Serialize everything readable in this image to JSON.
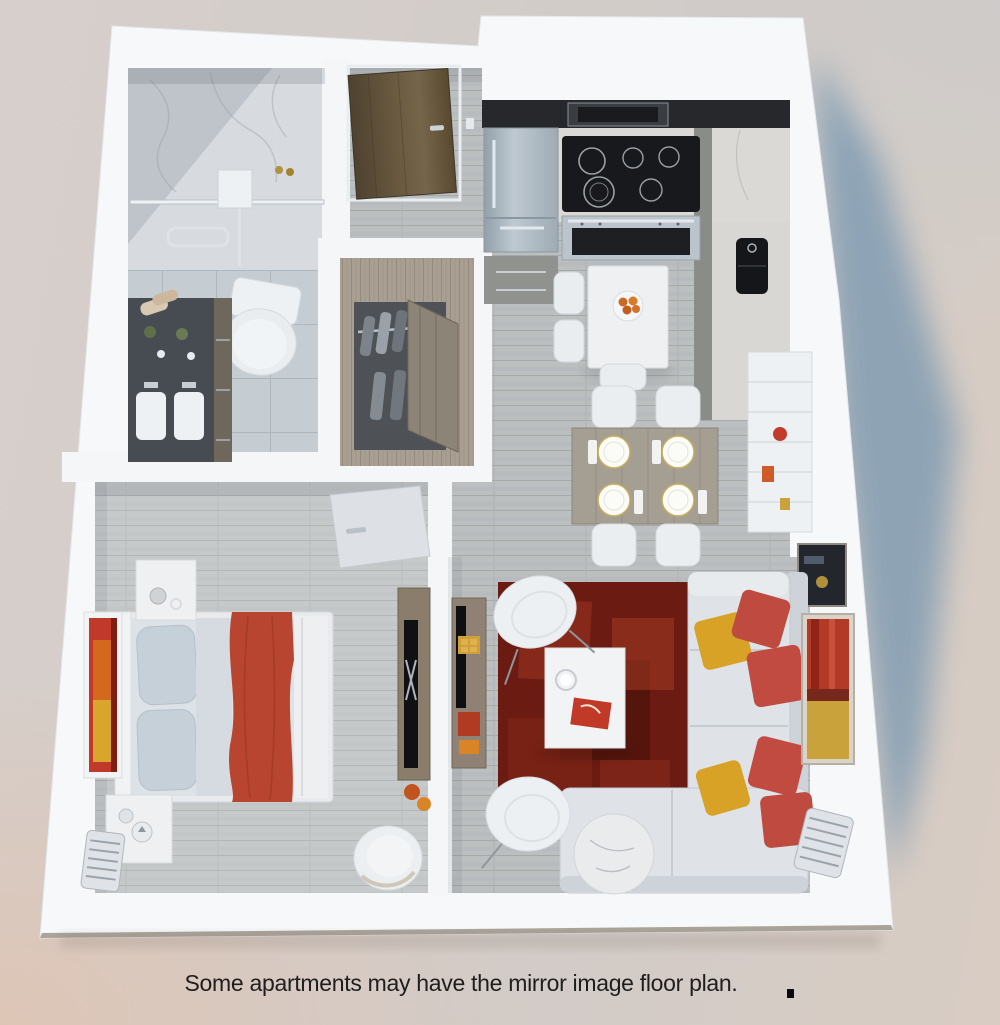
{
  "caption": {
    "text": "Some apartments may have the mirror image floor plan."
  },
  "palette": {
    "wall_white": "#f6f8fa",
    "shadow_blue": "#7d9ab1",
    "rug_red": "#6b1b12",
    "pillow_red": "#c14a41",
    "pillow_yellow": "#d7a226",
    "blanket_red": "#b8452f",
    "sofa_gray": "#dfe3e7",
    "stainless_steel": "#aeb9c2",
    "appliance_black": "#17191c",
    "entry_door_wood": "#64543c",
    "closet_wood": "#a89f92",
    "console_wood": "#8f8274",
    "marble_white": "#d7dade",
    "tile_gray": "#c6cdd2",
    "plank_gray": "#babdbe",
    "art_red": "#b23a27",
    "art_yellow": "#c9a23b",
    "accent_orange": "#cf5a2a"
  }
}
